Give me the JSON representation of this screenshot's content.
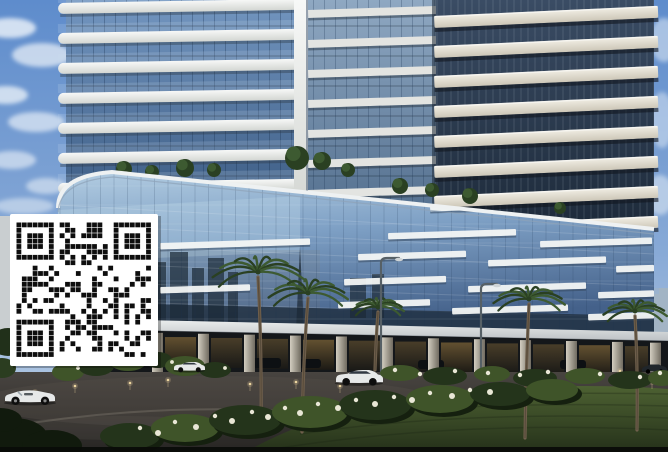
{
  "meta": {
    "description": "Architectural rendering photo of a high-rise residential complex with curved balcony towers, a reflective glass podium, palm trees, lawn and driveway, with a QR code overlaid on the left side",
    "width": 668,
    "height": 452
  },
  "colors": {
    "sky_top": "#5e8ccc",
    "sky_low": "#b9cde6",
    "cloud": "#eef4fa",
    "band_white": "#eceeec",
    "band_cream": "#e7e3d8",
    "glass_left": "#5f83ae",
    "glass_mid": "#7e9ab8",
    "glass_void": "#233148",
    "podium_top": "#b3cde2",
    "podium_bot": "#4a6789",
    "stripe_white": "#f3f5f4",
    "fascia": "#dde1e2",
    "colonnade": "#14171a",
    "pillar_light": "#cdc8bb",
    "pillar_dark": "#7b766b",
    "warm_light": "#b98e4f",
    "road": "#413e3b",
    "lawn": "#46592e",
    "lawn_dark": "#222d18",
    "shrub": "#24341b",
    "shrub_light": "#3f5429",
    "flower": "#e9e7d6",
    "palm_frond": "#3d5a31",
    "palm_frond_dark": "#2a4022",
    "palm_trunk": "#6f5f4c",
    "qr_bg": "#ffffff",
    "qr_fg": "#0e0e0e",
    "car_white": "#e6e8e8",
    "car_dark": "#20262b",
    "lamp": "#566066",
    "left_wall": "#c9ced0",
    "city_reflection": "#22303e",
    "distant_city": "#a4b4c2"
  },
  "sky": {
    "clouds": [
      {
        "x": 10,
        "y": 28,
        "rx": 26,
        "ry": 10,
        "o": 0.8
      },
      {
        "x": 42,
        "y": 55,
        "rx": 30,
        "ry": 12,
        "o": 0.7
      },
      {
        "x": 6,
        "y": 95,
        "rx": 22,
        "ry": 9,
        "o": 0.75
      },
      {
        "x": 36,
        "y": 122,
        "rx": 28,
        "ry": 10,
        "o": 0.65
      },
      {
        "x": 12,
        "y": 160,
        "rx": 24,
        "ry": 9,
        "o": 0.6
      },
      {
        "x": 46,
        "y": 186,
        "rx": 20,
        "ry": 8,
        "o": 0.55
      },
      {
        "x": 24,
        "y": 206,
        "rx": 30,
        "ry": 8,
        "o": 0.5
      },
      {
        "x": 664,
        "y": 40,
        "rx": 14,
        "ry": 22,
        "o": 0.5
      },
      {
        "x": 662,
        "y": 120,
        "rx": 12,
        "ry": 28,
        "o": 0.45
      },
      {
        "x": 660,
        "y": 195,
        "rx": 14,
        "ry": 20,
        "o": 0.5
      }
    ]
  },
  "distant_city": [
    {
      "x": 644,
      "y": 288,
      "w": 24,
      "h": 46,
      "o": 0.45
    },
    {
      "x": 650,
      "y": 294,
      "w": 10,
      "h": 40,
      "o": 0.8
    },
    {
      "x": 659,
      "y": 288,
      "w": 9,
      "h": 46,
      "o": 0.8
    },
    {
      "x": 646,
      "y": 308,
      "w": 7,
      "h": 26,
      "o": 0.7
    }
  ],
  "towers": {
    "left": {
      "glass_x": 66,
      "glass_w": 236,
      "bottom": 192,
      "band_x": 58,
      "band_w": 246,
      "band_h": 11,
      "first_y": 3,
      "period": 30,
      "count": 7,
      "tilt": -1
    },
    "mid": {
      "glass_x": 296,
      "glass_w": 140,
      "bottom": 214,
      "pillar_x": 294,
      "pillar_w": 14,
      "band_x": 308,
      "band_w": 128,
      "band_h": 8,
      "first_y": 10,
      "period": 30,
      "count": 7,
      "tilt": -1.8
    },
    "right": {
      "glass_x": 436,
      "glass_w": 218,
      "bottom": 230,
      "band_x": 434,
      "band_w": 224,
      "band_h": 12,
      "first_y": 16,
      "period": 30,
      "count": 8,
      "tilt": -2.6
    }
  },
  "roof_garden": [
    {
      "x": 124,
      "y": 169,
      "r": 8
    },
    {
      "x": 152,
      "y": 172,
      "r": 7
    },
    {
      "x": 185,
      "y": 168,
      "r": 9
    },
    {
      "x": 214,
      "y": 170,
      "r": 7
    },
    {
      "x": 297,
      "y": 158,
      "r": 12
    },
    {
      "x": 322,
      "y": 161,
      "r": 9
    },
    {
      "x": 348,
      "y": 170,
      "r": 7
    },
    {
      "x": 400,
      "y": 186,
      "r": 8
    },
    {
      "x": 432,
      "y": 190,
      "r": 7
    },
    {
      "x": 470,
      "y": 196,
      "r": 8
    },
    {
      "x": 560,
      "y": 208,
      "r": 6
    }
  ],
  "podium": {
    "stripes": [
      {
        "x": 430,
        "y": 205,
        "w": 125
      },
      {
        "x": 562,
        "y": 212,
        "w": 92
      },
      {
        "x": 160,
        "y": 243,
        "w": 150
      },
      {
        "x": 388,
        "y": 233,
        "w": 128
      },
      {
        "x": 540,
        "y": 241,
        "w": 112
      },
      {
        "x": 358,
        "y": 254,
        "w": 108
      },
      {
        "x": 488,
        "y": 260,
        "w": 118
      },
      {
        "x": 616,
        "y": 266,
        "w": 38
      },
      {
        "x": 160,
        "y": 287,
        "w": 90
      },
      {
        "x": 344,
        "y": 279,
        "w": 102
      },
      {
        "x": 468,
        "y": 286,
        "w": 118
      },
      {
        "x": 598,
        "y": 292,
        "w": 56
      },
      {
        "x": 338,
        "y": 302,
        "w": 92
      },
      {
        "x": 452,
        "y": 308,
        "w": 116
      },
      {
        "x": 588,
        "y": 314,
        "w": 66
      }
    ],
    "reflections": [
      {
        "x": 152,
        "y": 262,
        "w": 14,
        "h": 62
      },
      {
        "x": 170,
        "y": 252,
        "w": 18,
        "h": 72
      },
      {
        "x": 192,
        "y": 268,
        "w": 12,
        "h": 56
      },
      {
        "x": 208,
        "y": 258,
        "w": 16,
        "h": 66
      },
      {
        "x": 228,
        "y": 272,
        "w": 10,
        "h": 52
      },
      {
        "x": 350,
        "y": 278,
        "w": 16,
        "h": 40
      },
      {
        "x": 372,
        "y": 274,
        "w": 12,
        "h": 44
      }
    ],
    "spire": {
      "x": 296,
      "y": 246,
      "w": 8,
      "h": 84
    }
  },
  "colonnade": {
    "pillars": [
      152,
      198,
      244,
      290,
      336,
      382,
      428,
      474,
      520,
      566,
      612,
      650
    ],
    "pillar_w": 11,
    "garage_cars": [
      {
        "x": 253,
        "y": 358,
        "w": 28,
        "h": 10
      },
      {
        "x": 297,
        "y": 359,
        "w": 24,
        "h": 9
      },
      {
        "x": 418,
        "y": 360,
        "w": 26,
        "h": 9
      },
      {
        "x": 560,
        "y": 360,
        "w": 26,
        "h": 9
      }
    ]
  },
  "ground": {
    "lights": [
      {
        "x": 35,
        "y": 392
      },
      {
        "x": 75,
        "y": 386
      },
      {
        "x": 130,
        "y": 383
      },
      {
        "x": 168,
        "y": 380
      },
      {
        "x": 250,
        "y": 384
      },
      {
        "x": 296,
        "y": 382
      },
      {
        "x": 340,
        "y": 386
      },
      {
        "x": 575,
        "y": 373
      },
      {
        "x": 620,
        "y": 371
      },
      {
        "x": 652,
        "y": 382
      }
    ],
    "island_bushes": [
      {
        "x": 68,
        "y": 372,
        "rx": 16,
        "ry": 9
      },
      {
        "x": 96,
        "y": 366,
        "rx": 18,
        "ry": 10
      },
      {
        "x": 128,
        "y": 362,
        "rx": 18,
        "ry": 9
      },
      {
        "x": 158,
        "y": 360,
        "rx": 14,
        "ry": 8
      },
      {
        "x": 185,
        "y": 366,
        "rx": 20,
        "ry": 10
      },
      {
        "x": 215,
        "y": 370,
        "rx": 16,
        "ry": 8
      }
    ],
    "island_flowers": [
      [
        78,
        368
      ],
      [
        104,
        362
      ],
      [
        136,
        358
      ],
      [
        172,
        362
      ],
      [
        200,
        366
      ],
      [
        225,
        368
      ]
    ],
    "mid_shrubs": [
      {
        "x": 400,
        "y": 373,
        "rx": 20,
        "ry": 8
      },
      {
        "x": 445,
        "y": 376,
        "rx": 22,
        "ry": 9
      },
      {
        "x": 492,
        "y": 374,
        "rx": 18,
        "ry": 8
      },
      {
        "x": 535,
        "y": 378,
        "rx": 22,
        "ry": 9
      },
      {
        "x": 585,
        "y": 376,
        "rx": 20,
        "ry": 8
      },
      {
        "x": 630,
        "y": 380,
        "rx": 22,
        "ry": 9
      },
      {
        "x": 662,
        "y": 378,
        "rx": 14,
        "ry": 8
      }
    ],
    "mid_flowers": [
      [
        395,
        370
      ],
      [
        420,
        374
      ],
      [
        455,
        371
      ],
      [
        488,
        373
      ],
      [
        520,
        375
      ],
      [
        548,
        372
      ],
      [
        600,
        374
      ],
      [
        640,
        377
      ],
      [
        660,
        373
      ]
    ],
    "front_shrubs": [
      {
        "x": 130,
        "y": 436,
        "rx": 30,
        "ry": 13
      },
      {
        "x": 185,
        "y": 428,
        "rx": 34,
        "ry": 14
      },
      {
        "x": 245,
        "y": 420,
        "rx": 36,
        "ry": 15
      },
      {
        "x": 310,
        "y": 412,
        "rx": 38,
        "ry": 16
      },
      {
        "x": 375,
        "y": 405,
        "rx": 36,
        "ry": 15
      },
      {
        "x": 440,
        "y": 399,
        "rx": 34,
        "ry": 14
      },
      {
        "x": 500,
        "y": 394,
        "rx": 30,
        "ry": 12
      },
      {
        "x": 552,
        "y": 390,
        "rx": 26,
        "ry": 11
      }
    ],
    "front_flowers": [
      [
        140,
        428
      ],
      [
        158,
        433
      ],
      [
        175,
        422
      ],
      [
        196,
        427
      ],
      [
        215,
        416
      ],
      [
        232,
        421
      ],
      [
        252,
        412
      ],
      [
        268,
        417
      ],
      [
        285,
        408
      ],
      [
        300,
        413
      ],
      [
        318,
        404
      ],
      [
        338,
        408
      ],
      [
        356,
        400
      ],
      [
        375,
        404
      ],
      [
        394,
        397
      ],
      [
        412,
        400
      ],
      [
        430,
        393
      ],
      [
        452,
        396
      ],
      [
        470,
        390
      ],
      [
        490,
        392
      ]
    ],
    "corner_bushes": [
      {
        "x": 14,
        "y": 438,
        "rx": 34,
        "ry": 20
      },
      {
        "x": 52,
        "y": 446,
        "rx": 30,
        "ry": 16
      },
      {
        "x": 0,
        "y": 420,
        "rx": 22,
        "ry": 12
      }
    ]
  },
  "palms": [
    {
      "x": 262,
      "crown_y": 272,
      "base_y": 430,
      "r": 46,
      "lean": -4
    },
    {
      "x": 303,
      "crown_y": 293,
      "base_y": 432,
      "r": 40,
      "lean": 5
    },
    {
      "x": 376,
      "crown_y": 307,
      "base_y": 370,
      "r": 26,
      "lean": 2
    },
    {
      "x": 526,
      "crown_y": 299,
      "base_y": 438,
      "r": 36,
      "lean": 3
    },
    {
      "x": 638,
      "crown_y": 311,
      "base_y": 430,
      "r": 32,
      "lean": -3
    }
  ],
  "lamps": [
    {
      "x": 381,
      "top": 258,
      "base": 376,
      "arm": 18
    },
    {
      "x": 481,
      "top": 284,
      "base": 372,
      "arm": 16
    }
  ],
  "cars": [
    {
      "type": "convertible",
      "x": 4,
      "y": 389,
      "w": 52
    },
    {
      "type": "sedan",
      "x": 174,
      "y": 362,
      "w": 31
    },
    {
      "type": "sedan",
      "x": 336,
      "y": 370,
      "w": 47
    },
    {
      "type": "dark",
      "x": 642,
      "y": 364,
      "w": 25
    }
  ],
  "left_wall": {
    "x": 0,
    "y": 216,
    "w": 13,
    "h": 118
  },
  "qr": {
    "x": 10,
    "y": 214,
    "w": 148,
    "h": 152,
    "modules": 25,
    "seed": 7
  }
}
